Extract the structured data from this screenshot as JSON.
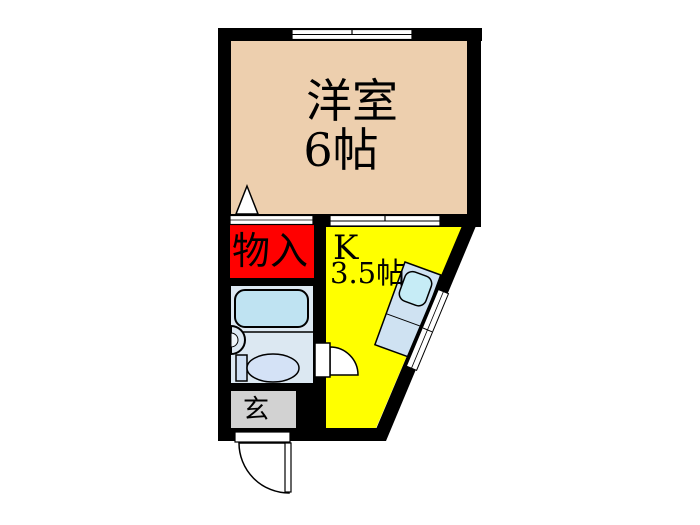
{
  "plan": {
    "rooms": {
      "western": {
        "name": "洋室",
        "area": "6帖"
      },
      "kitchen": {
        "name": "K",
        "area": "3.5帖"
      },
      "closet": {
        "name": "物入"
      },
      "entrance": {
        "name": "玄"
      }
    },
    "colors": {
      "wall": "#000000",
      "western_floor": "#edcfae",
      "kitchen_floor": "#ffff00",
      "closet_fill": "#ff0000",
      "entrance_floor": "#d2d2d2",
      "bathroom_floor": "#dce8f2",
      "bathtub": "#bfe3f2",
      "fixture": "#d4e2f6",
      "tank": "#cfe0f4",
      "counter": "#cfe2f2",
      "counter_sink": "#c6ecf6",
      "symbol": "#ffffff"
    }
  }
}
